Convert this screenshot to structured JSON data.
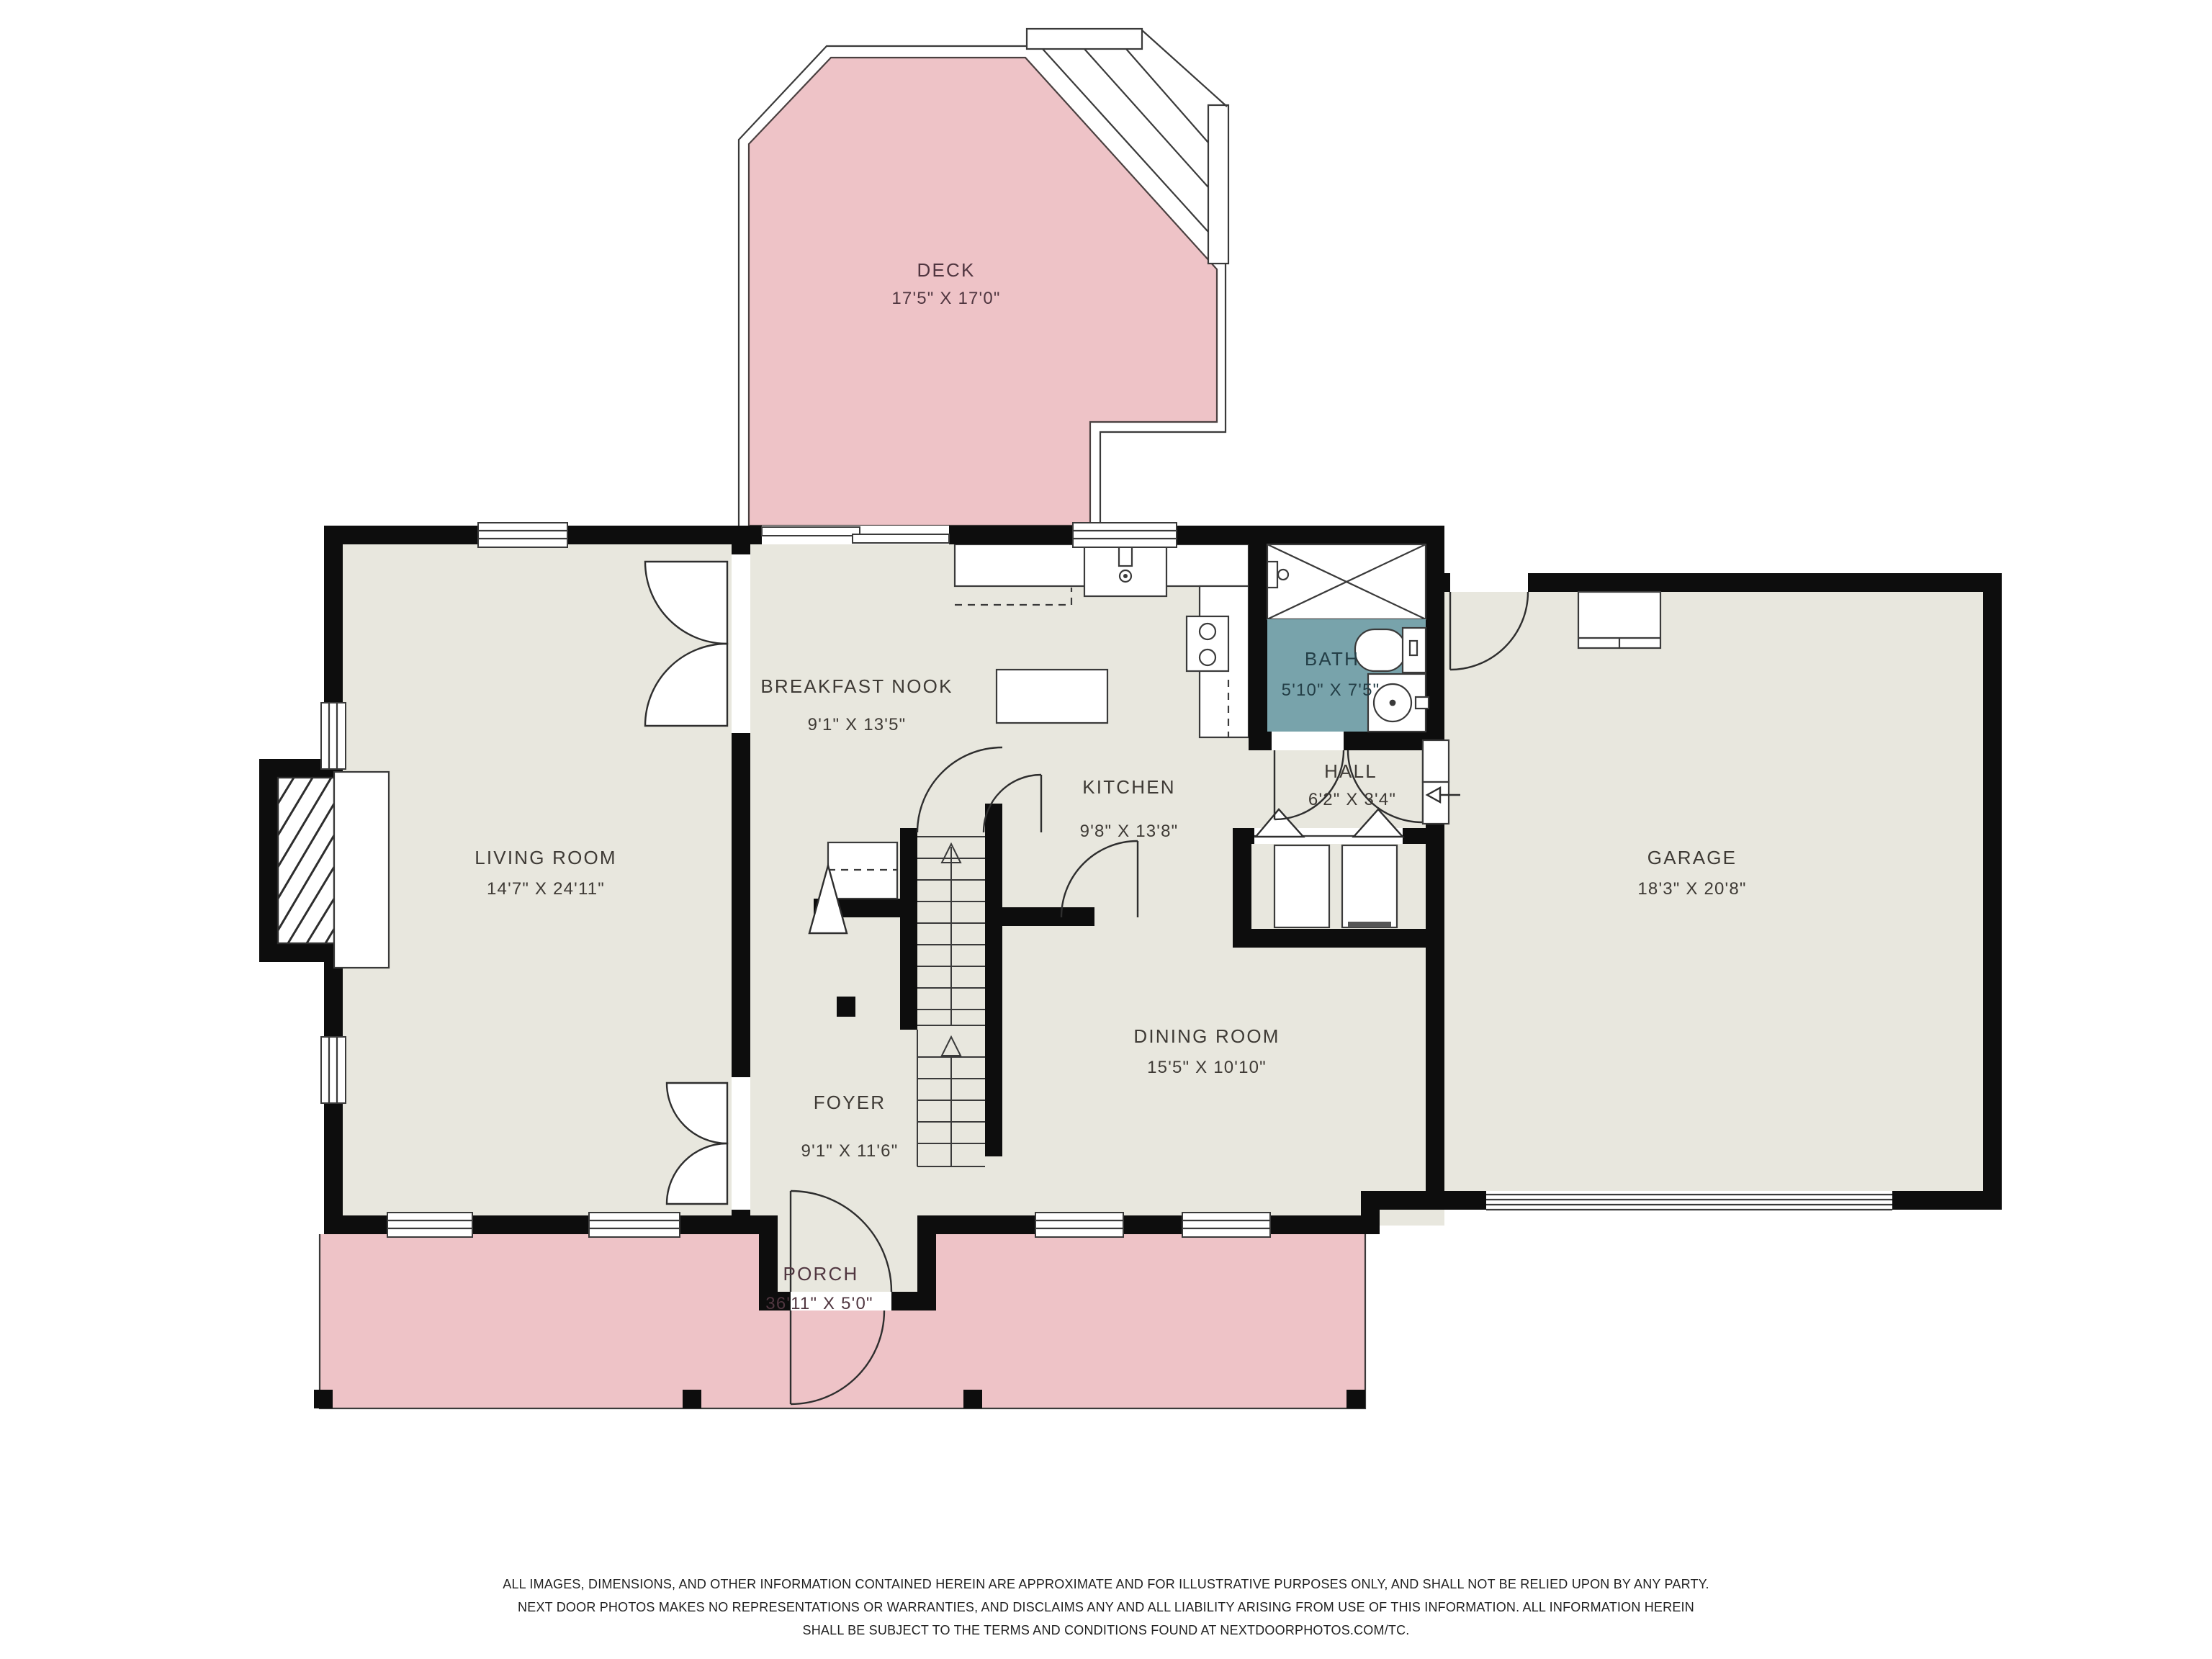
{
  "rooms": {
    "deck": {
      "name": "DECK",
      "dims": "17'5\" X 17'0\""
    },
    "breakfast_nook": {
      "name": "BREAKFAST NOOK",
      "dims": "9'1\" X 13'5\""
    },
    "kitchen": {
      "name": "KITCHEN",
      "dims": "9'8\" X 13'8\""
    },
    "bath": {
      "name": "BATH",
      "dims": "5'10\" X 7'5\""
    },
    "hall": {
      "name": "HALL",
      "dims": "6'2\" X 3'4\""
    },
    "living_room": {
      "name": "LIVING ROOM",
      "dims": "14'7\" X 24'11\""
    },
    "garage": {
      "name": "GARAGE",
      "dims": "18'3\" X 20'8\""
    },
    "foyer": {
      "name": "FOYER",
      "dims": "9'1\" X 11'6\""
    },
    "dining_room": {
      "name": "DINING ROOM",
      "dims": "15'5\" X 10'10\""
    },
    "porch": {
      "name": "PORCH",
      "dims": "36'11\" X 5'0\""
    }
  },
  "colors": {
    "floor": "#e8e7de",
    "deck_porch": "#eec3c7",
    "bath_floor": "#78a3ab",
    "wall": "#0d0d0d",
    "label": "#3e3a35"
  },
  "footer": {
    "line1": "ALL IMAGES, DIMENSIONS, AND OTHER INFORMATION CONTAINED HEREIN ARE APPROXIMATE AND FOR ILLUSTRATIVE PURPOSES ONLY, AND SHALL NOT BE RELIED UPON BY ANY PARTY.",
    "line2": "NEXT DOOR PHOTOS MAKES NO REPRESENTATIONS OR WARRANTIES, AND DISCLAIMS ANY AND ALL LIABILITY ARISING FROM USE OF THIS INFORMATION. ALL INFORMATION HEREIN",
    "line3": "SHALL BE SUBJECT TO THE TERMS AND CONDITIONS FOUND AT NEXTDOORPHOTOS.COM/TC."
  }
}
